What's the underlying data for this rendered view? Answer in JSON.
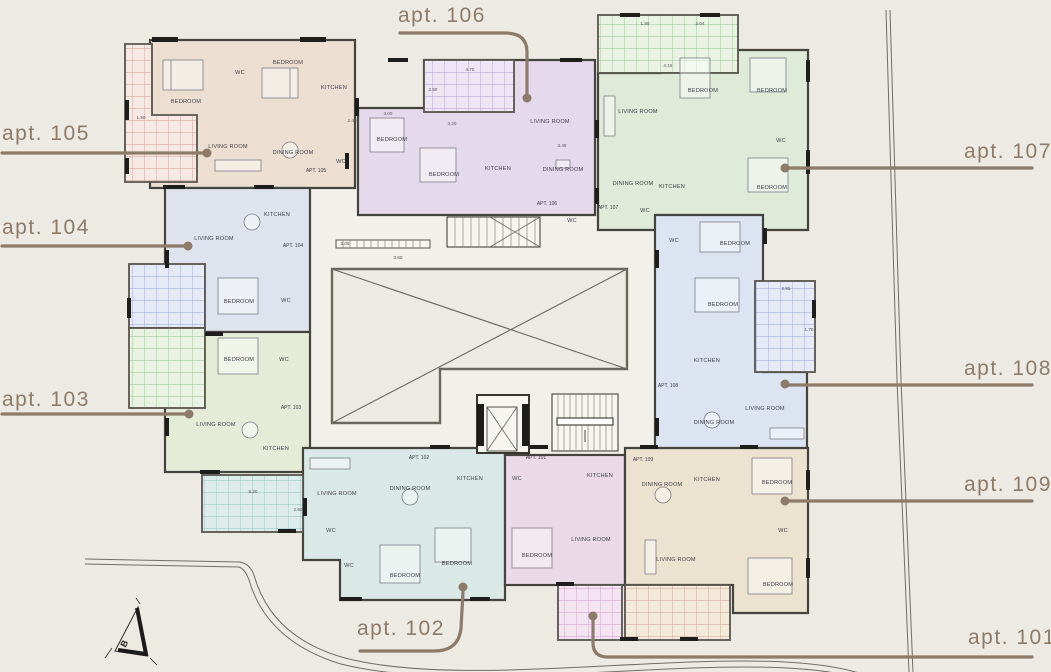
{
  "palette": {
    "background": "#edeae3",
    "common_area": "#f2f0ea",
    "wall": "#2f2d2a",
    "callout_brown": "#8d7b6a",
    "room_text": "#3e3e48"
  },
  "room_labels": {
    "bedroom": "BEDROOM",
    "living": "LIVING ROOM",
    "dining": "DINING ROOM",
    "kitchen": "KITCHEN",
    "wc": "WC"
  },
  "apartments": [
    {
      "num": "101",
      "tag": "APT. 101",
      "fill": "#ead9e6",
      "balcony_line": "#cf9ec7"
    },
    {
      "num": "102",
      "tag": "APT. 102",
      "fill": "#dbe9e6",
      "balcony_line": "#8fc3c0"
    },
    {
      "num": "103",
      "tag": "APT. 103",
      "fill": "#e4ecd8",
      "balcony_line": "#8fc3c0"
    },
    {
      "num": "104",
      "tag": "APT. 104",
      "fill": "#dfe3ed",
      "balcony_line": "#96a0cc"
    },
    {
      "num": "105",
      "tag": "APT. 105",
      "fill": "#ecdfd2",
      "balcony_line": "#cf9288"
    },
    {
      "num": "106",
      "tag": "APT. 106",
      "fill": "#e5daeb",
      "balcony_line": "#ad93c9"
    },
    {
      "num": "107",
      "tag": "APT. 107",
      "fill": "#dfead8",
      "balcony_line": "#8fc08b"
    },
    {
      "num": "108",
      "tag": "APT. 108",
      "fill": "#dce4f1",
      "balcony_line": "#93a3d6"
    },
    {
      "num": "109",
      "tag": "APT. 109",
      "fill": "#ece2d0",
      "balcony_line": "#d5a097"
    }
  ],
  "callouts": {
    "apt101": "apt. 101",
    "apt102": "apt. 102",
    "apt103": "apt. 103",
    "apt104": "apt. 104",
    "apt105": "apt. 105",
    "apt106": "apt. 106",
    "apt107": "apt. 107",
    "apt108": "apt. 108",
    "apt109": "apt. 109"
  },
  "north_label": "B",
  "dims": [
    "4.70",
    "2.50",
    "3.00",
    "3.20",
    "5.20",
    "2.90",
    "2.95",
    "1.70",
    "3.45",
    "4.15",
    "1.80",
    "2.04",
    "3.60",
    "1.50",
    "2.40",
    "3.05"
  ]
}
